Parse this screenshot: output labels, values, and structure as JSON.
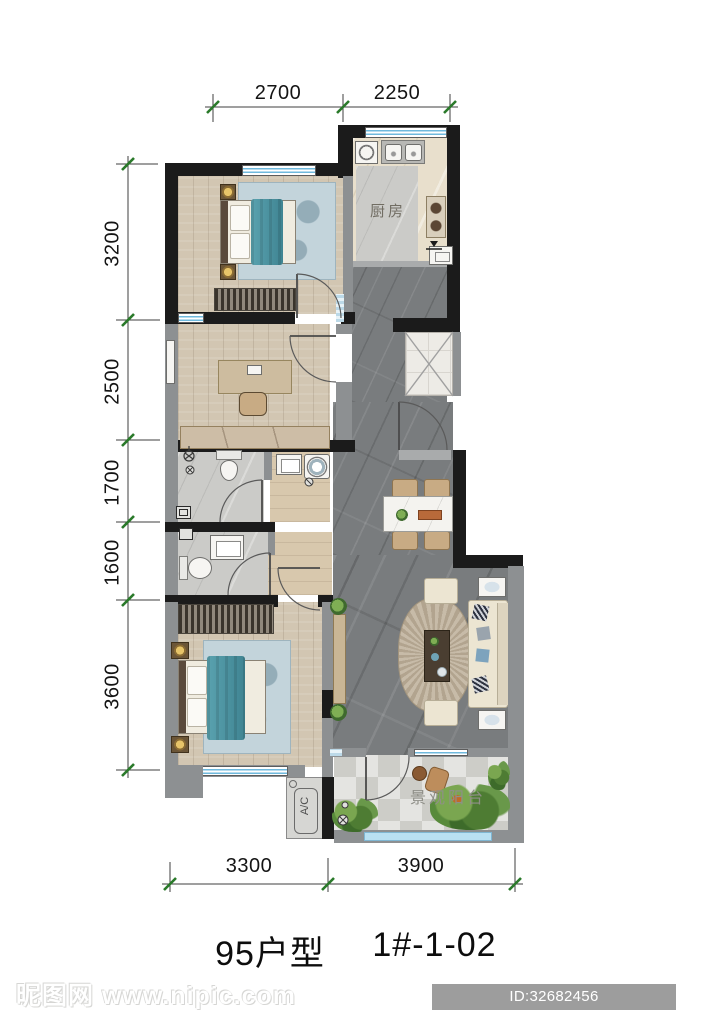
{
  "title": {
    "type_label": "95户型",
    "unit_label": "1#-1-02"
  },
  "labels": {
    "kitchen": "厨房",
    "balcony": "景观阳台",
    "ac": "A/C"
  },
  "dimensions": {
    "top": [
      "2700",
      "2250"
    ],
    "left": [
      "3200",
      "2500",
      "1700",
      "1600",
      "3600"
    ],
    "bottom": [
      "3300",
      "3900"
    ]
  },
  "watermark": {
    "text": "昵图网 www.nipic.com"
  },
  "badge": {
    "text": "ID:32682456 NO:20251220104210853102"
  },
  "colors": {
    "wall_black": "#1b1b1b",
    "wall_gray": "#8d9092",
    "window_blue": "#6fb9dd",
    "bed_teal": "#4f97a6",
    "tick_green": "#2a7a2a",
    "floor_marble_dark": "#797c7e",
    "floor_wood": "#d2c6b2"
  }
}
